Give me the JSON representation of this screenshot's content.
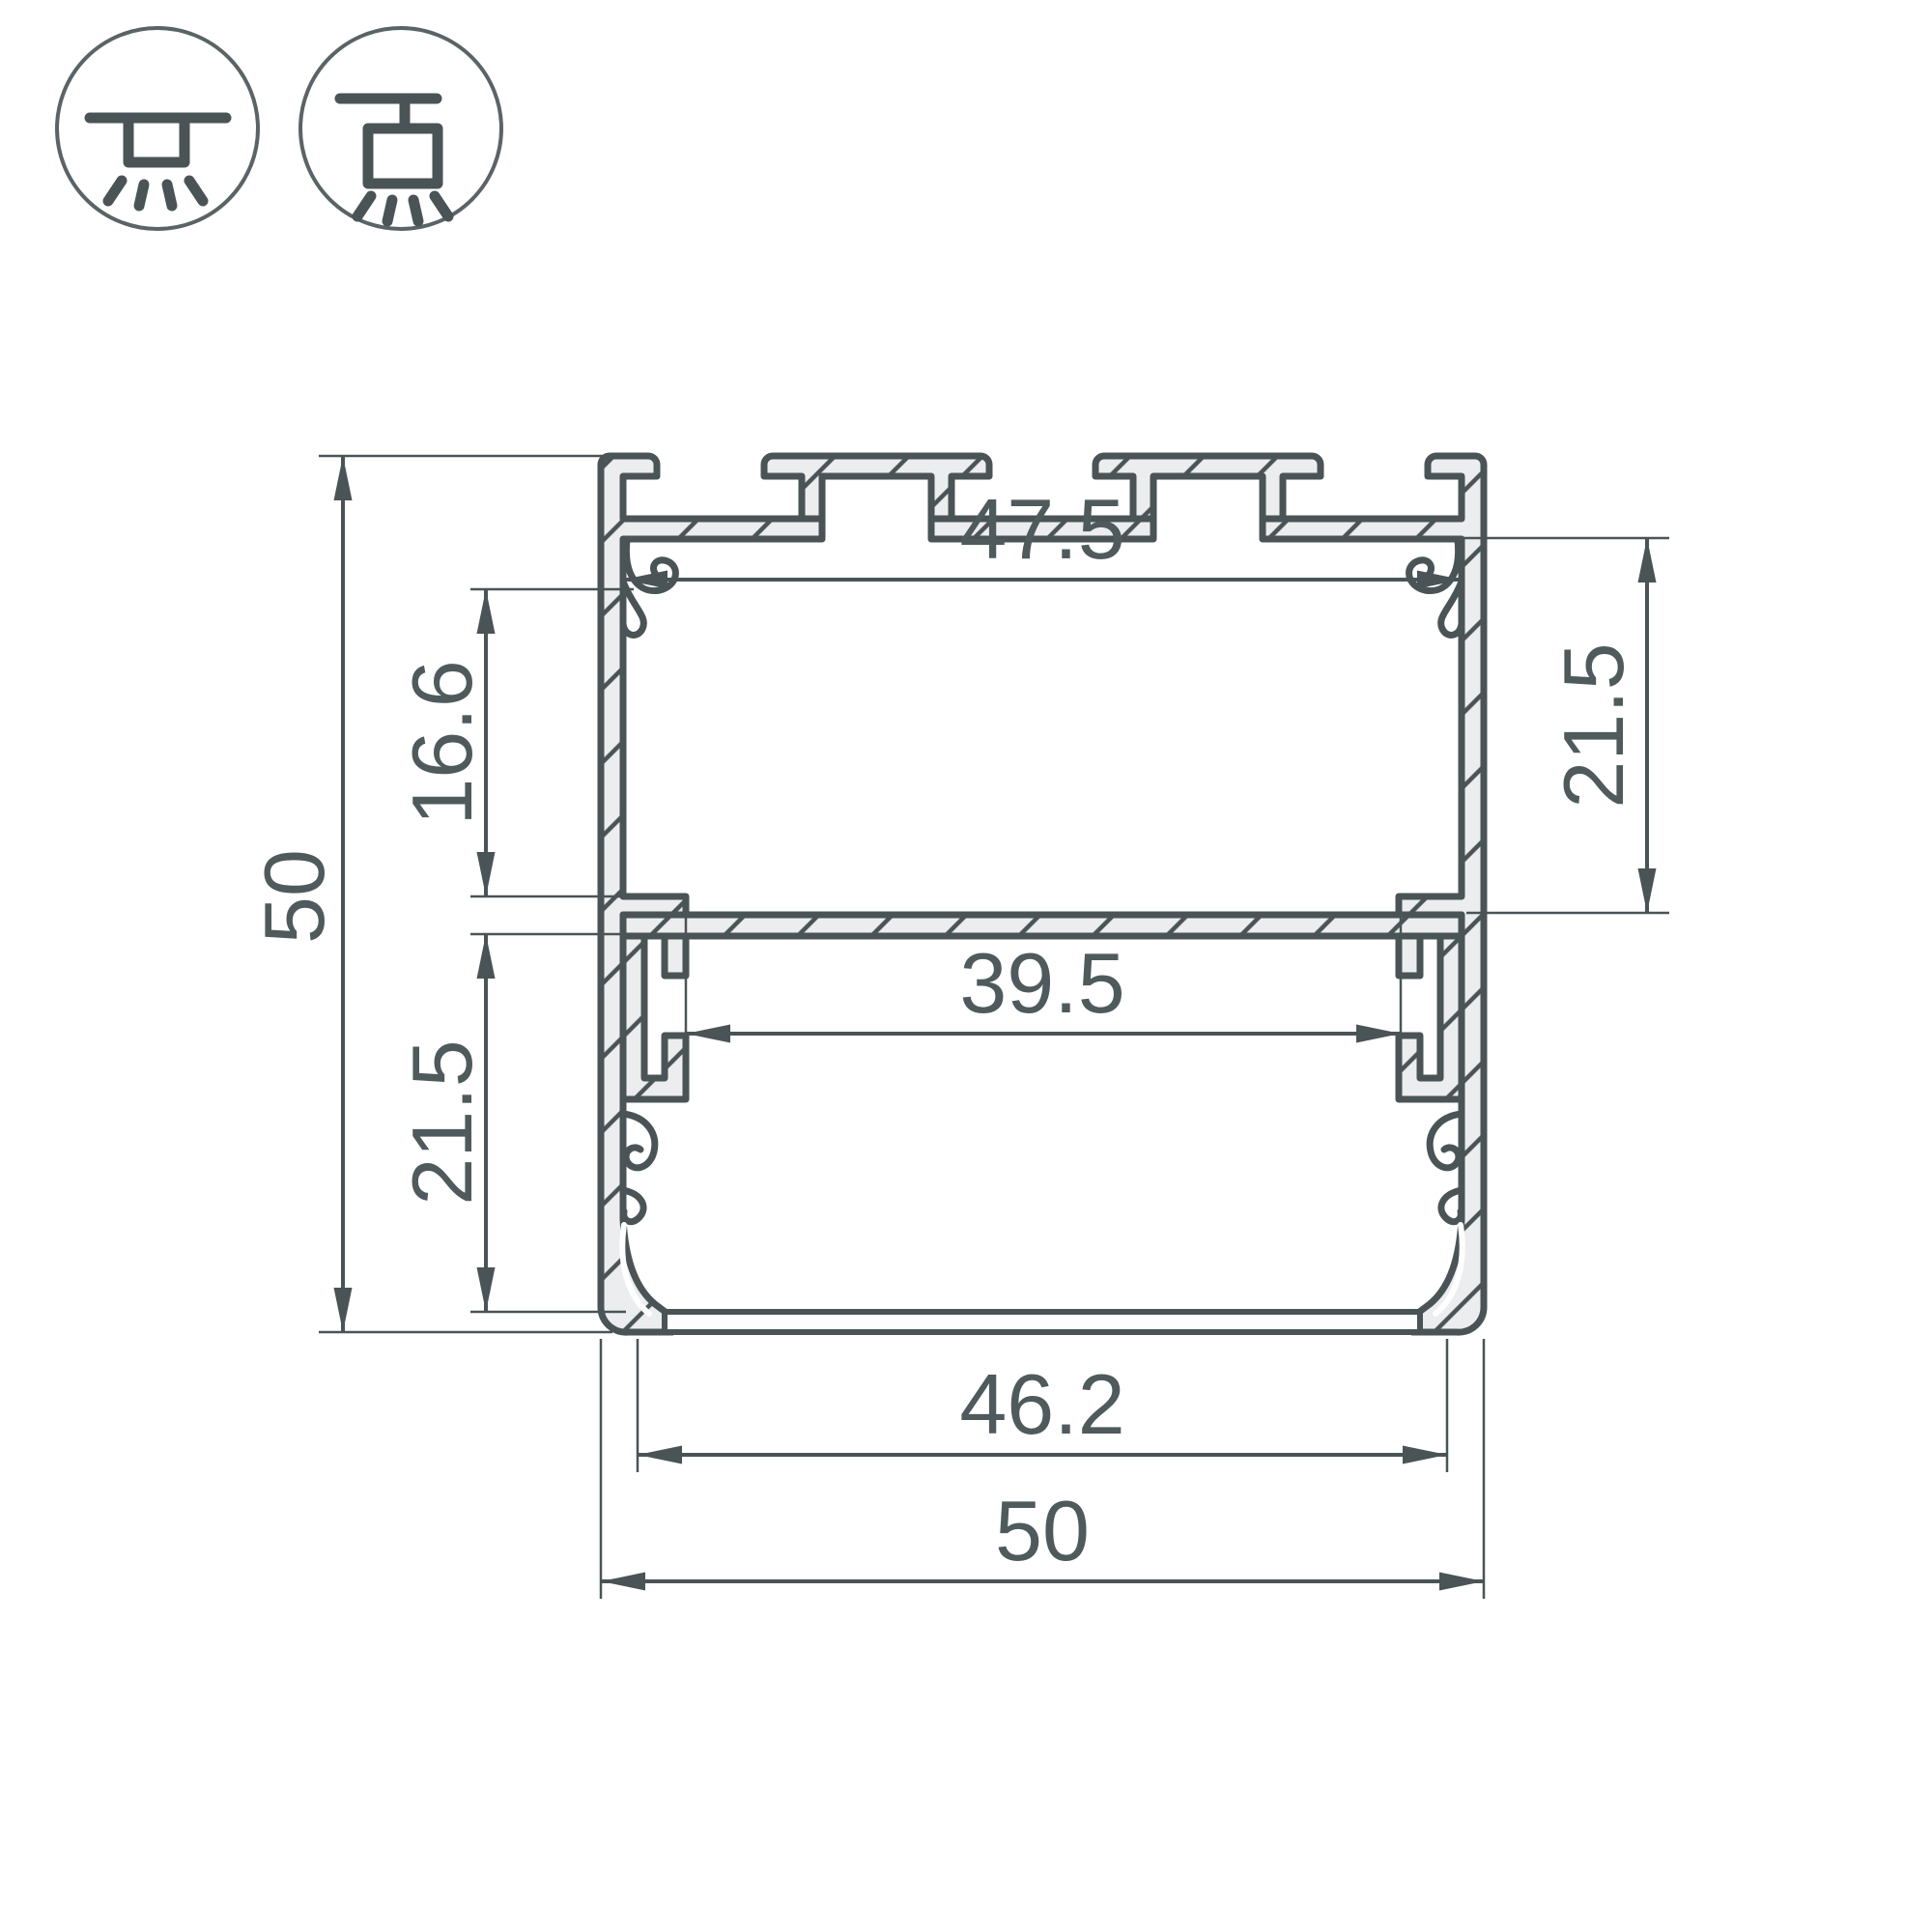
{
  "drawing": {
    "type": "profile-cross-section",
    "units": "mm"
  },
  "icons": {
    "surface_mount": "surface-mount-icon",
    "pendant_mount": "pendant-mount-icon"
  },
  "dimensions": {
    "total_height": {
      "label": "50"
    },
    "top_chamber_offset": {
      "label": "16.6"
    },
    "lower_chamber_height": {
      "label": "21.5"
    },
    "upper_chamber_height": {
      "label": "21.5"
    },
    "upper_inner_width": {
      "label": "47.5"
    },
    "led_platform_width": {
      "label": "39.5"
    },
    "bottom_inner_width": {
      "label": "46.2"
    },
    "total_width": {
      "label": "50"
    }
  },
  "colors": {
    "line": "#4A5456",
    "dimension": "#4A5457",
    "text": "#4F5A5D",
    "metal_fill": "#ECEDEE",
    "background": "#FFFFFF"
  }
}
